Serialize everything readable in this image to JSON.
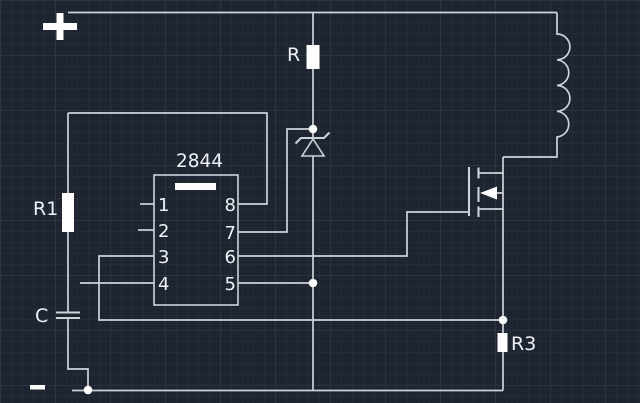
{
  "canvas": {
    "background_color": "#1e2531",
    "grid_minor_color": "#232c39",
    "grid_major_color": "#2a3443",
    "wire_color": "#ced3da",
    "component_fill_color": "#ffffff",
    "text_color": "#eef1f5"
  },
  "power": {
    "positive_label": "+",
    "negative_label": "−"
  },
  "components": {
    "r_top": {
      "label": "R"
    },
    "r1": {
      "label": "R1"
    },
    "r3": {
      "label": "R3"
    },
    "c": {
      "label": "C"
    }
  },
  "ic": {
    "part_number": "2844",
    "pins_left": [
      "1",
      "2",
      "3",
      "4"
    ],
    "pins_right": [
      "8",
      "7",
      "6",
      "5"
    ]
  }
}
